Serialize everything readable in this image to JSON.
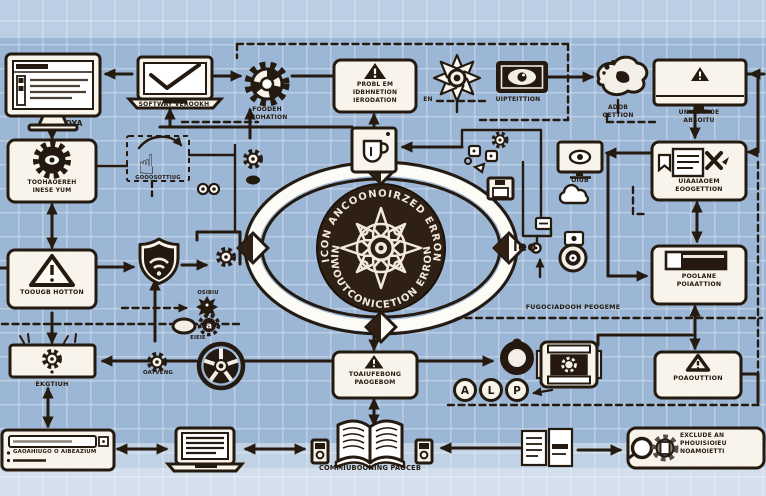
{
  "colors": {
    "background": "#9cb7d6",
    "ink": "#241a10",
    "box_fill": "#f8f4ec",
    "dark_circle": "#2e2014",
    "arc_text": "#f2ead9"
  },
  "top": {
    "oya": "OYA",
    "software_version": "SOFTWAY VEROOKH",
    "gear_label": [
      "FOODEH",
      "LUOHATION"
    ],
    "problem_lines": [
      "PROBL EM",
      "IDBHNETION",
      "IERODATION"
    ],
    "inspection_prefix": "EN",
    "inspection_label": "UIPTEITTION",
    "blob_label": [
      "ADOB",
      "GETTION"
    ],
    "monitor_error": [
      "UNIAIATIOE",
      "ABSOITU"
    ]
  },
  "left": {
    "gearbox_label": [
      "TOOHAOEREH",
      "INESE YUM"
    ],
    "hand_caption": "GOOOSOTTIUG",
    "warning_label": "TOOUGB HOTTON",
    "osibiu": "OSIBIU",
    "gear_letter": "a",
    "eieie": "EIEIE",
    "ekgtiuh": "EKGTIUH",
    "oatveng": "OATVENG"
  },
  "center": {
    "arc_top": "ICON ANCOONOIRZED ERRON",
    "arc_bottom": "NIWOUTCONICETION ERRON"
  },
  "right": {
    "oiub": "OIUB",
    "leo": "leo",
    "doc_label": [
      "UIAAIAOEM",
      "EOOGETTION"
    ],
    "pool_label": [
      "POOLANE",
      "POIAATTION"
    ],
    "fug_caption": "FUGOCIADOOH PEOGEME"
  },
  "bottom": {
    "ts_label": [
      "TOAIUFEBONG",
      "PAOGEBOM"
    ],
    "alp": [
      "A",
      "L",
      "P"
    ],
    "resolution": "POAOUTTION",
    "search_text": "GAOAHIUGO O AIBEAZIUM",
    "book_caption": "COMMIUBOONING PAOCEB",
    "exclude_lines": [
      "EXCLUDE AN",
      "PHOUISIOIEU",
      "NOAMOIETTI"
    ]
  }
}
